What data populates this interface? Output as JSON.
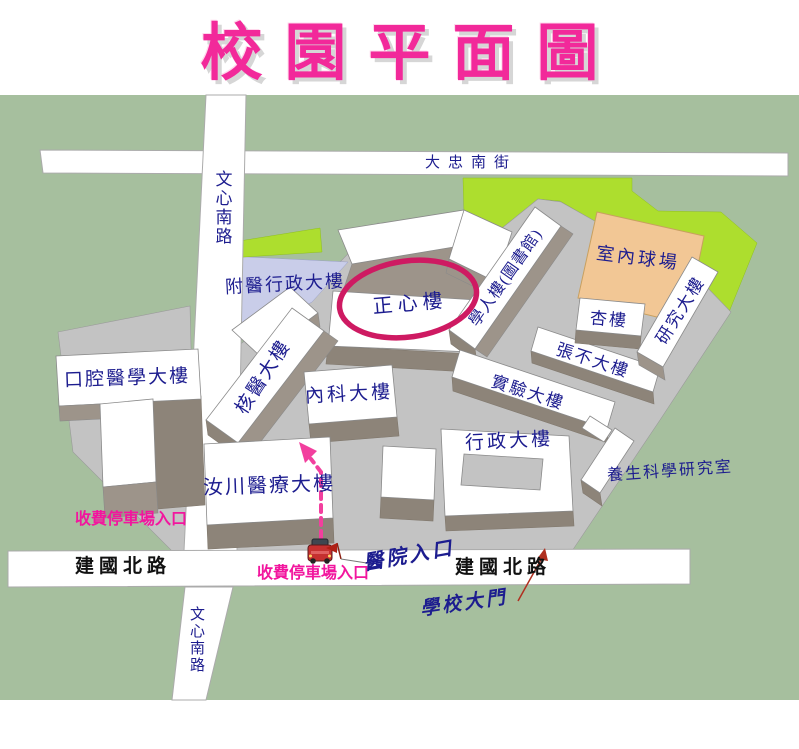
{
  "title": "校園平面圖",
  "colors": {
    "title_pink": "#F2299A",
    "highlight_ellipse": "#CE1A62",
    "route_pink": "#F23F9E",
    "entrance_text_red": "#8B1F10",
    "building_text_navy": "#1D1D8F",
    "street_label_olive": "#8A7C14",
    "campus_gray": "#C3C3C3",
    "grass_green": "#A6BF9E",
    "lawn_bright_green": "#ADDE2E",
    "court_tan": "#F2C795",
    "parking_lavender": "#C9CDE9"
  },
  "roads": {
    "wenxin_north": "文心南路",
    "wenxin_south": "文心南路",
    "dazhong": "大忠南街",
    "jianguo_left": "建國北路",
    "jianguo_right": "建國北路"
  },
  "buildings": {
    "fuyi_admin": "附醫行政大樓",
    "zhengxin": "正心樓",
    "xueren": "學人樓(圖書館)",
    "indoor_court": "室內球場",
    "research": "研究大樓",
    "xing": "杏樓",
    "zhangbu": "張不大樓",
    "experiment": "實驗大樓",
    "heyi": "核醫大樓",
    "neike": "內科大樓",
    "oral": "口腔醫學大樓",
    "admin": "行政大樓",
    "ruchuan": "汝川醫療大樓",
    "yangsheng": "養生科學研究室"
  },
  "markers": {
    "parking_entrance_left": "收費停車場入口",
    "parking_entrance_bottom": "收費停車場入口",
    "hospital_entrance": "醫院入口",
    "school_gate": "學校大門"
  }
}
